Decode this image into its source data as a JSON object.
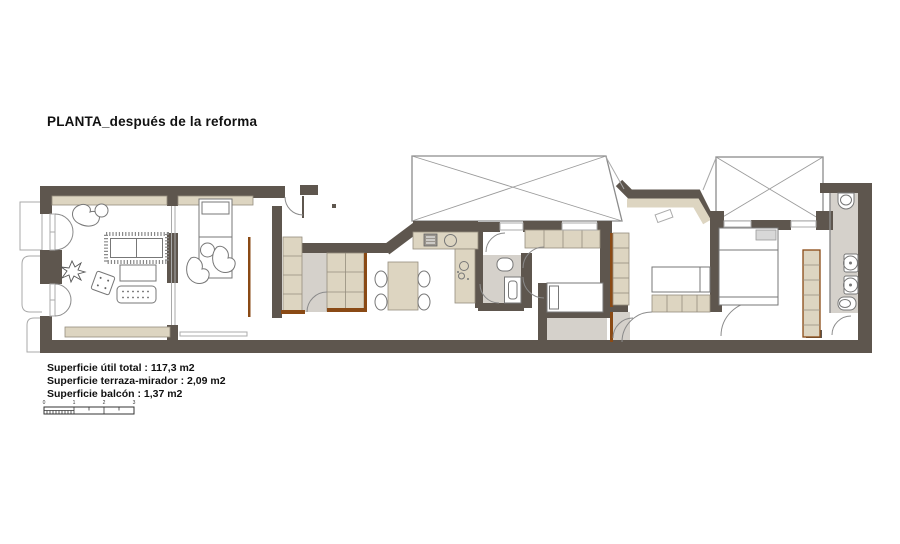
{
  "title": "PLANTA_después de la reforma",
  "legend": {
    "lines": [
      "Superficie útil total : 117,3 m2",
      "Superficie terraza-mirador : 2,09 m2",
      "Superficie balcón : 1,37 m2"
    ]
  },
  "scale_bar": {
    "labels": [
      "0",
      "1",
      "2",
      "3"
    ]
  },
  "colors": {
    "bg": "#ffffff",
    "text": "#111111",
    "wall": "#5e564e",
    "cabinet": "#ddd5c1",
    "cabinetline": "#958d7e",
    "floor": "#d5d1cb",
    "accent": "#8a4a15",
    "line": "#8a8a8a",
    "furniture": "#777777"
  }
}
